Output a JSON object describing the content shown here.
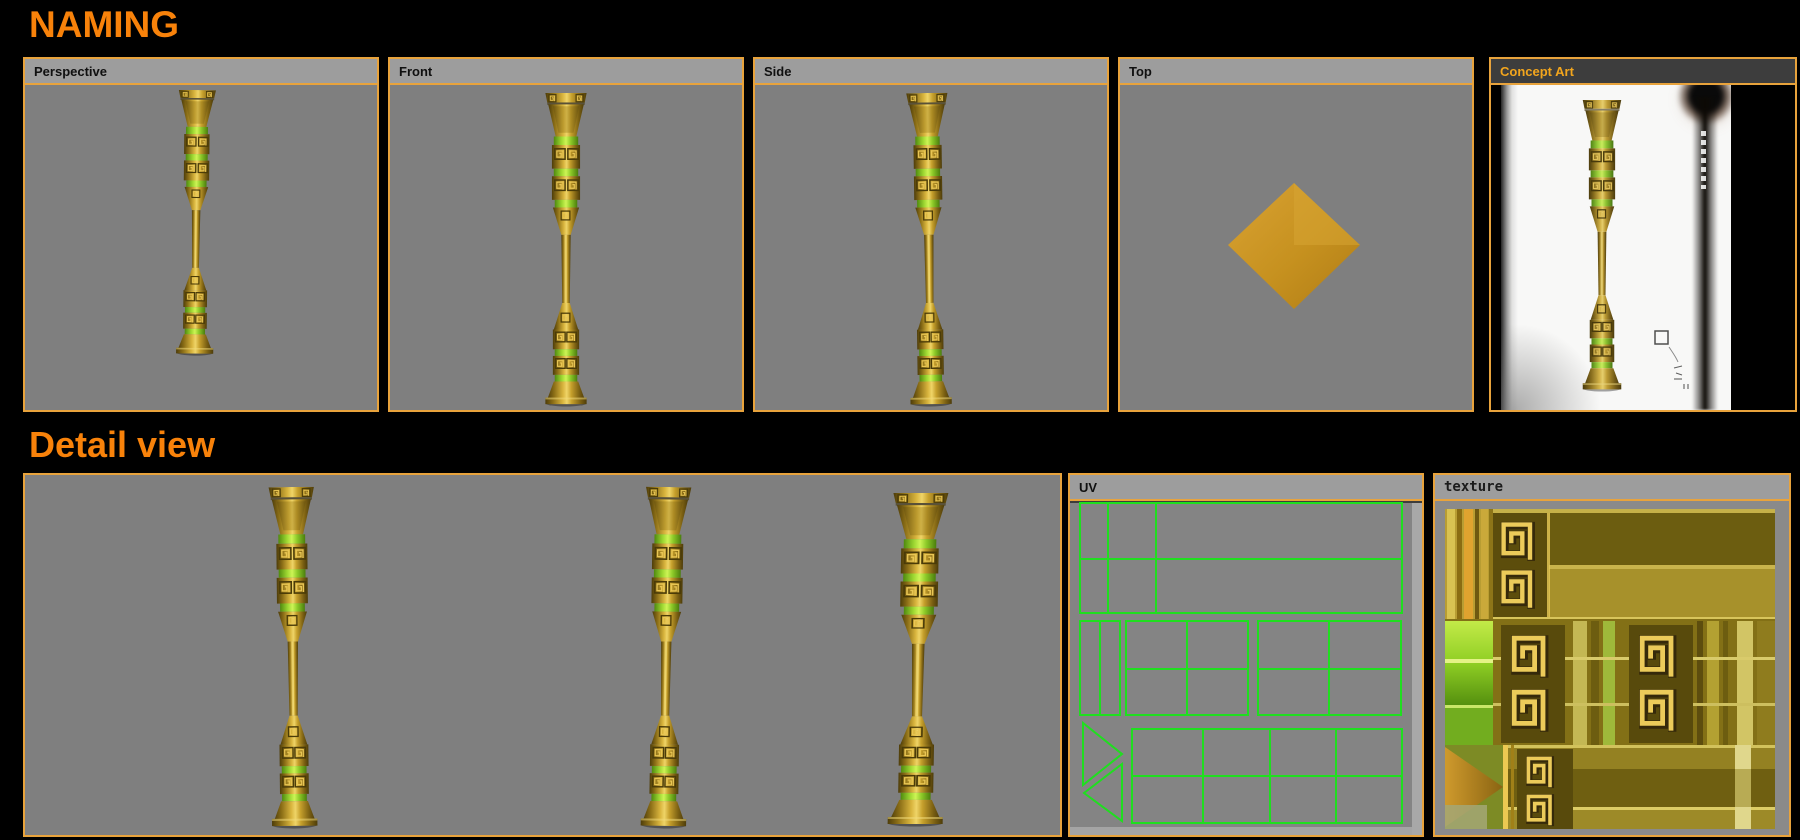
{
  "titles": {
    "main": "NAMING",
    "detail": "Detail view"
  },
  "viewports": {
    "perspective": {
      "label": "Perspective"
    },
    "front": {
      "label": "Front"
    },
    "side": {
      "label": "Side"
    },
    "top": {
      "label": "Top"
    },
    "concept": {
      "label": "Concept Art"
    }
  },
  "panels": {
    "uv": {
      "label": "UV"
    },
    "texture": {
      "label": "texture"
    }
  },
  "colors": {
    "background": "#000000",
    "title_orange": "#f8820a",
    "panel_border": "#e8a33c",
    "header_bg": "#9d9d9d",
    "header_text": "#101010",
    "concept_header_bg": "#3d3d3d",
    "concept_header_text": "#f2a51d",
    "viewport_bg": "#7f7f7f",
    "uv_wireframe_green": "#1fdf1f",
    "model_gold": "#d4af37",
    "model_glow_green": "#a9e23d"
  }
}
